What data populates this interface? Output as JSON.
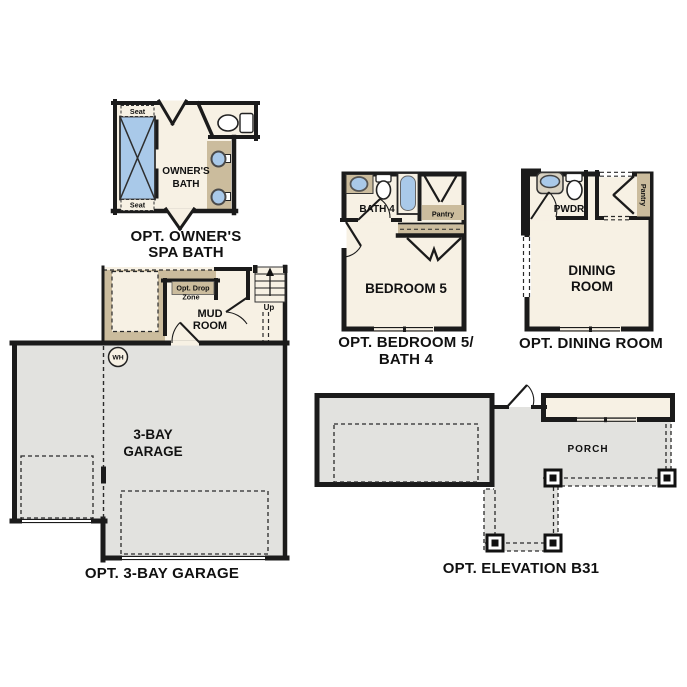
{
  "palette": {
    "interior_cream": "#F7F1E4",
    "accent_tan": "#CBBC9D",
    "fixture_blue": "#A9C9E9",
    "concrete_gray": "#E2E2DF",
    "wall_black": "#1B1B1B",
    "background": "#FFFFFF"
  },
  "sections": {
    "spa_bath": {
      "title_line1": "OPT. OWNER'S",
      "title_line2": "SPA BATH",
      "room_line1": "OWNER'S",
      "room_line2": "BATH",
      "seat_top": "Seat",
      "seat_bottom": "Seat"
    },
    "bedroom5_bath4": {
      "title_line1": "OPT. BEDROOM 5/",
      "title_line2": "BATH 4",
      "bedroom": "BEDROOM 5",
      "bath": "BATH 4",
      "pantry": "Pantry"
    },
    "dining": {
      "title": "OPT. DINING ROOM",
      "room_line1": "DINING",
      "room_line2": "ROOM",
      "powder": "PWDR",
      "pantry": "Pantry"
    },
    "garage": {
      "title": "OPT. 3-BAY GARAGE",
      "room_line1": "3-BAY",
      "room_line2": "GARAGE",
      "water_heater": "WH",
      "mud_line1": "MUD",
      "mud_line2": "ROOM",
      "drop_line1": "Opt. Drop",
      "drop_line2": "Zone",
      "up": "Up"
    },
    "elevation": {
      "title": "OPT. ELEVATION B31",
      "porch": "PORCH"
    }
  }
}
